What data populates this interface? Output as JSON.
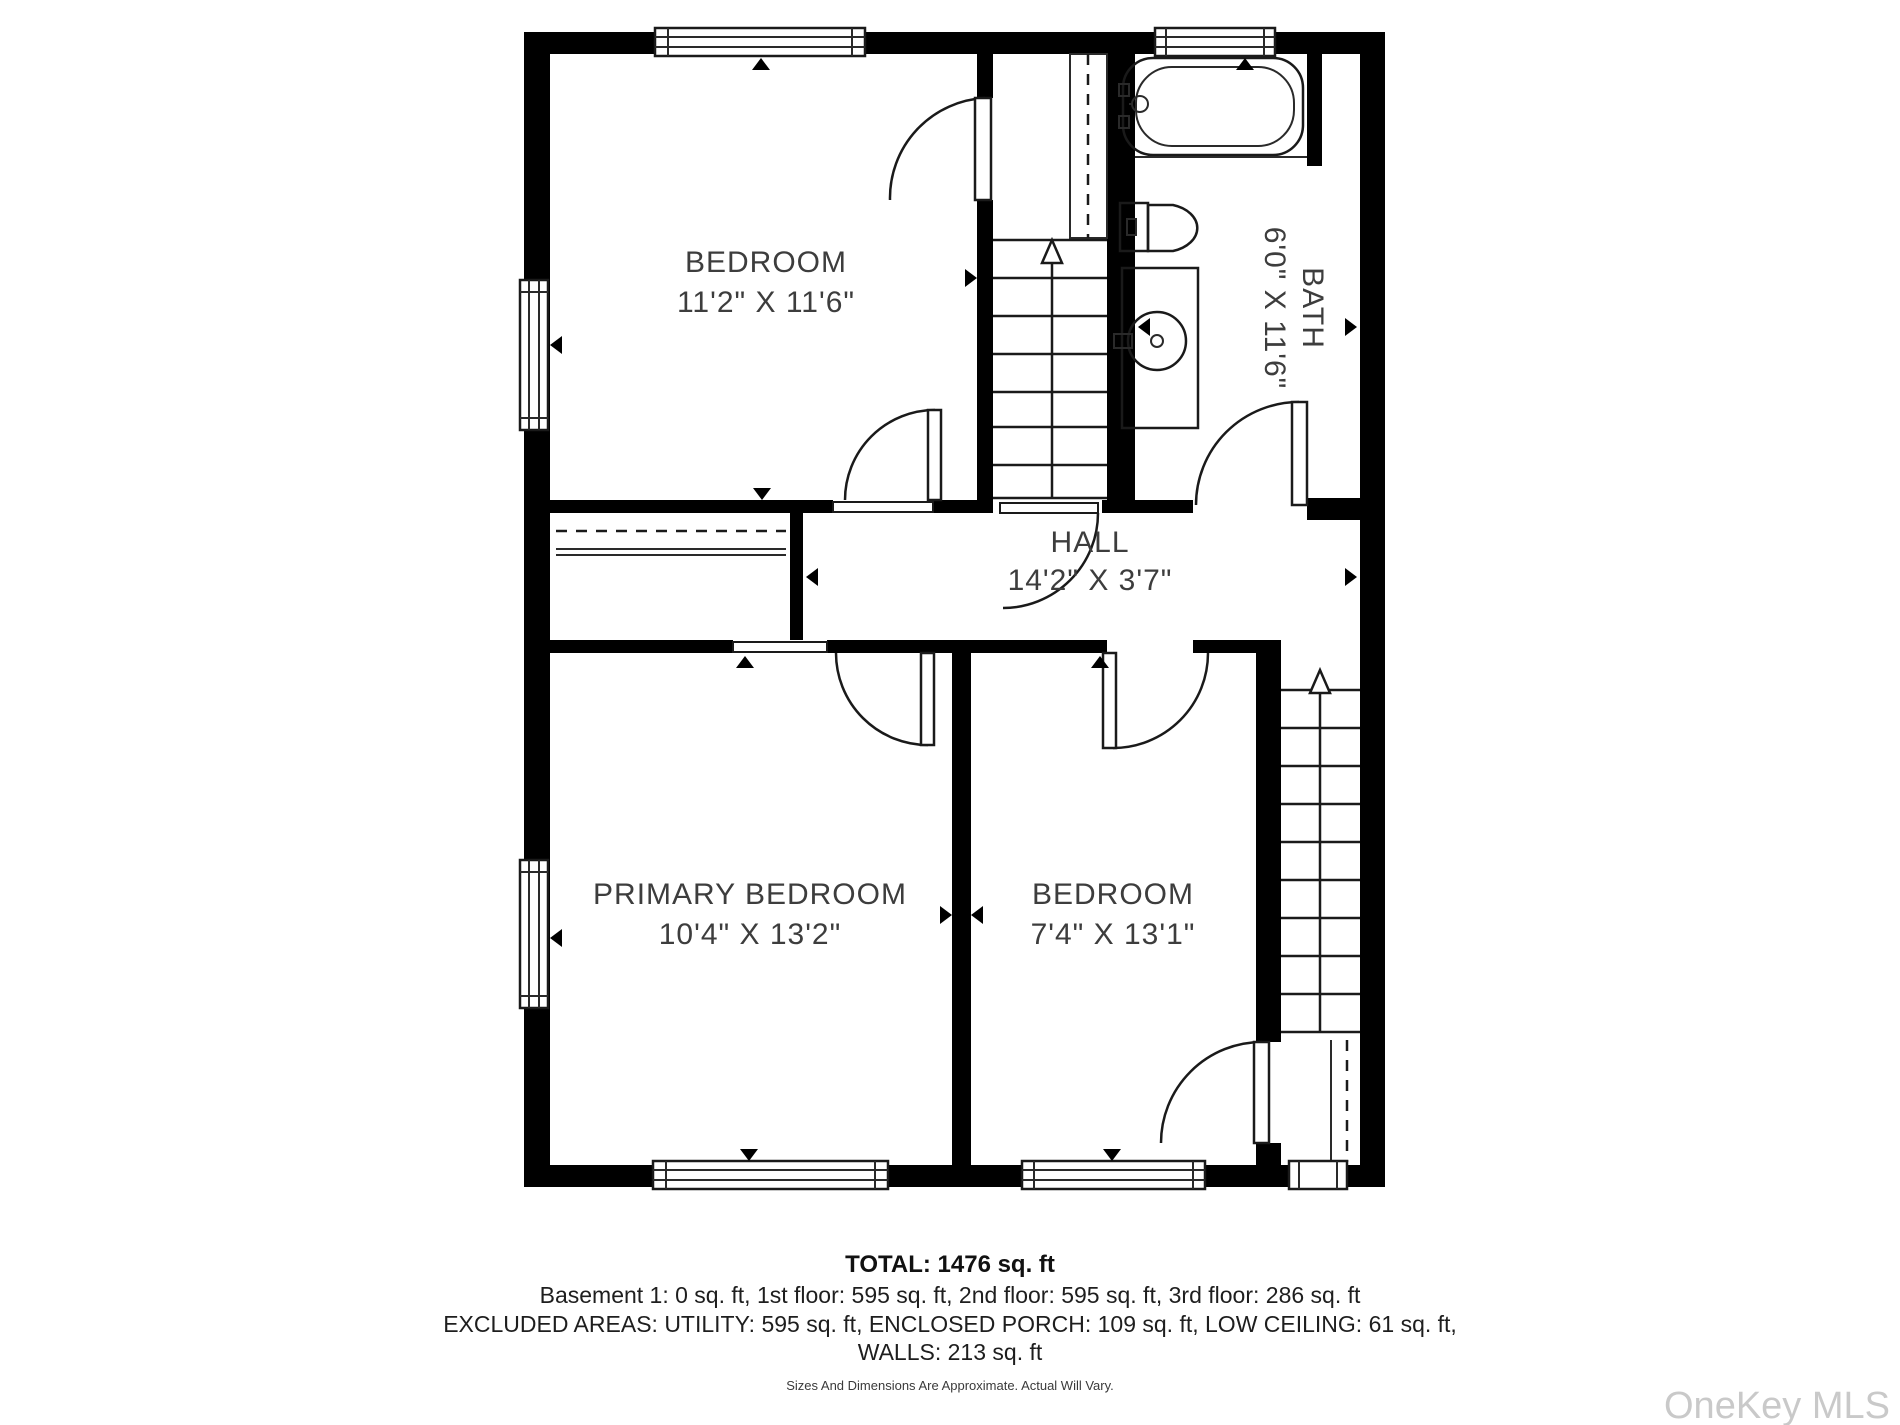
{
  "plan": {
    "rooms": [
      {
        "id": "bedroom-top",
        "label": "BEDROOM",
        "dims": "11'2\" X 11'6\""
      },
      {
        "id": "bath",
        "label": "BATH",
        "dims": "6'0\" X 11'6\""
      },
      {
        "id": "hall",
        "label": "HALL",
        "dims": "14'2\" X 3'7\""
      },
      {
        "id": "primary-bedroom",
        "label": "PRIMARY BEDROOM",
        "dims": "10'4\" X 13'2\""
      },
      {
        "id": "bedroom-right",
        "label": "BEDROOM",
        "dims": "7'4\" X 13'1\""
      }
    ],
    "icons": {
      "bathtub": "bathtub-icon",
      "toilet": "toilet-icon",
      "sink": "sink-vanity-icon",
      "stairs_up_center": "stairs-up-arrow-icon",
      "stairs_up_right": "stairs-up-arrow-icon"
    }
  },
  "summary": {
    "total": "TOTAL: 1476 sq. ft",
    "floors": "Basement 1: 0 sq. ft, 1st floor: 595 sq. ft, 2nd floor: 595 sq. ft, 3rd floor: 286 sq. ft",
    "excluded": "EXCLUDED AREAS: UTILITY: 595 sq. ft, ENCLOSED PORCH: 109 sq. ft, LOW CEILING: 61 sq. ft,",
    "walls": "WALLS: 213 sq. ft",
    "disclaimer": "Sizes And Dimensions Are Approximate. Actual Will Vary."
  },
  "watermark": "OneKey MLS",
  "colors": {
    "wall": "#000000",
    "line": "#1a1a1a",
    "text": "#3d3d3d",
    "watermark": "#c9c9c9"
  }
}
